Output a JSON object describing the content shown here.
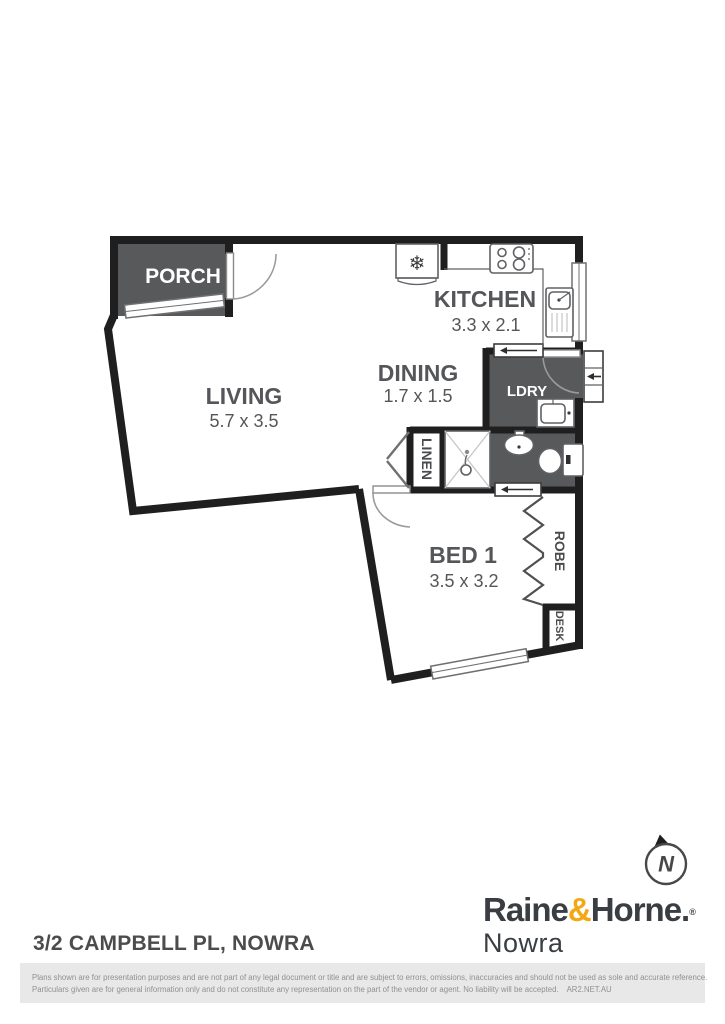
{
  "plan": {
    "rooms": {
      "porch": {
        "label": "PORCH"
      },
      "living": {
        "label": "LIVING",
        "dims": "5.7 x 3.5"
      },
      "kitchen": {
        "label": "KITCHEN",
        "dims": "3.3 x 2.1"
      },
      "dining": {
        "label": "DINING",
        "dims": "1.7 x 1.5"
      },
      "laundry": {
        "label": "LDRY"
      },
      "linen": {
        "label": "LINEN"
      },
      "bed1": {
        "label": "BED 1",
        "dims": "3.5 x 3.2"
      },
      "robe": {
        "label": "ROBE"
      },
      "desk": {
        "label": "DESK"
      }
    },
    "compass": {
      "letter": "N"
    },
    "icons": [
      "fridge-icon",
      "cooktop-icon",
      "kitchen-sink-icon",
      "laundry-tub-icon",
      "vanity-basin-icon",
      "toilet-icon",
      "shower-icon"
    ]
  },
  "footer": {
    "address": "3/2 CAMPBELL PL, NOWRA",
    "brand": {
      "name_part1": "Raine",
      "ampersand": "&",
      "name_part2": "Horne.",
      "registered": "®",
      "office": "Nowra"
    },
    "disclaimer_line1": "Plans shown are for presentation purposes and are not part of any legal document or title and are subject to errors, omissions, inaccuracies and should not be used as sole and accurate reference.",
    "disclaimer_line2": "Particulars given are for general information only and do not constitute any representation on the part of the vendor or agent. No liability will be accepted.",
    "plan_credit": "AR2.NET.AU"
  },
  "colors": {
    "wall": "#1f1f1f",
    "dark_room_fill": "#58595b",
    "room_label": "#55565a",
    "brand_dark": "#3a3e42",
    "brand_amber": "#f2a813",
    "disclaimer_bg": "#e8e8e8",
    "disclaimer_text": "#8f9092"
  }
}
